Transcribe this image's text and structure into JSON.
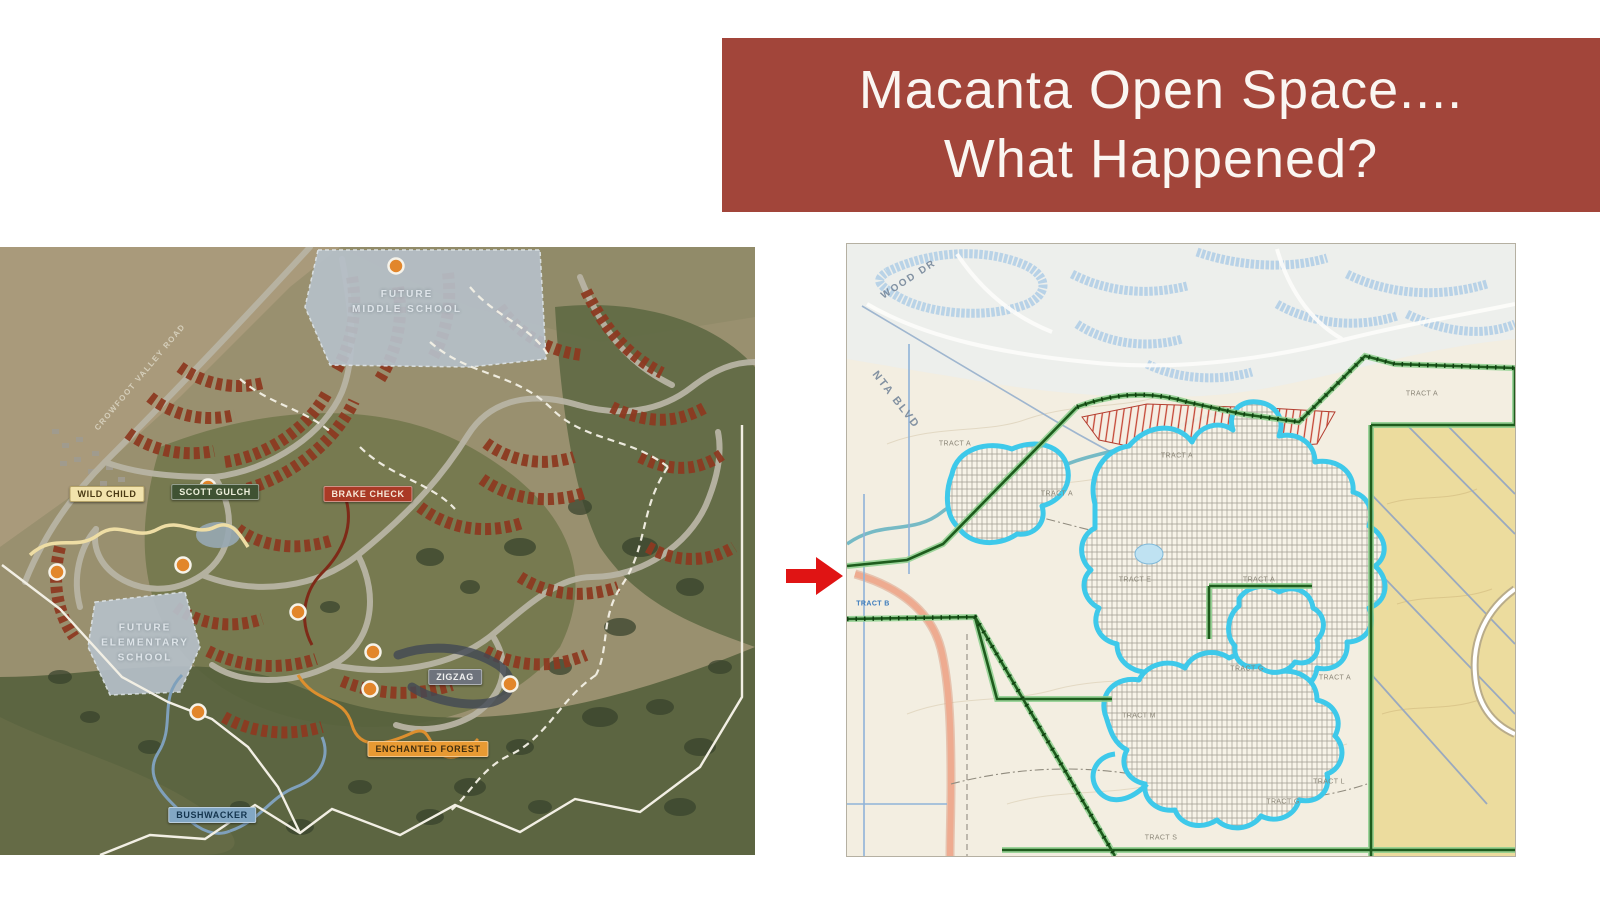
{
  "title": {
    "line1": "Macanta Open Space....",
    "line2": "What Happened?",
    "bg_color": "#A2453A",
    "text_color": "#FAF6F2"
  },
  "arrow": {
    "color": "#E01414"
  },
  "left_map": {
    "type": "aerial-master-plan",
    "road_label": "CROWFOOT VALLEY ROAD",
    "school_labels": {
      "middle": {
        "line1": "FUTURE",
        "line2": "MIDDLE SCHOOL"
      },
      "elementary": {
        "line1": "FUTURE",
        "line2": "ELEMENTARY",
        "line3": "SCHOOL"
      }
    },
    "trail_labels": [
      {
        "text": "WILD CHILD",
        "bg": "#F2E3AC",
        "fg": "#4A3A14"
      },
      {
        "text": "SCOTT GULCH",
        "bg": "#3F5233",
        "fg": "#EEF0DC"
      },
      {
        "text": "BRAKE CHECK",
        "bg": "#AA3A26",
        "fg": "#F7E9D9"
      },
      {
        "text": "ZIGZAG",
        "bg": "#6E737C",
        "fg": "#F0F0F0"
      },
      {
        "text": "ENCHANTED FOREST",
        "bg": "#E89A33",
        "fg": "#402E0E"
      },
      {
        "text": "BUSHWACKER",
        "bg": "#82A7C4",
        "fg": "#13344E"
      }
    ]
  },
  "right_map": {
    "type": "zoning-plat-map",
    "street_labels": [
      {
        "text": "WOOD DR"
      },
      {
        "text": "NTA BLVD"
      }
    ],
    "parcel_label": {
      "text": "TRACT B"
    },
    "tract_labels": [
      {
        "text": "TRACT A"
      },
      {
        "text": "TRACT A"
      },
      {
        "text": "TRACT A"
      },
      {
        "text": "TRACT A"
      },
      {
        "text": "TRACT A"
      },
      {
        "text": "TRACT A"
      },
      {
        "text": "TRACT E"
      },
      {
        "text": "TRACT G"
      },
      {
        "text": "TRACT G"
      },
      {
        "text": "TRACT M"
      },
      {
        "text": "TRACT L"
      },
      {
        "text": "TRACT S"
      }
    ],
    "boundary_color": "#1E5C1D",
    "highlight_color": "#3EC9EA",
    "open_space_color": "#ECDC9E",
    "hatch_color": "#C23B2A"
  }
}
